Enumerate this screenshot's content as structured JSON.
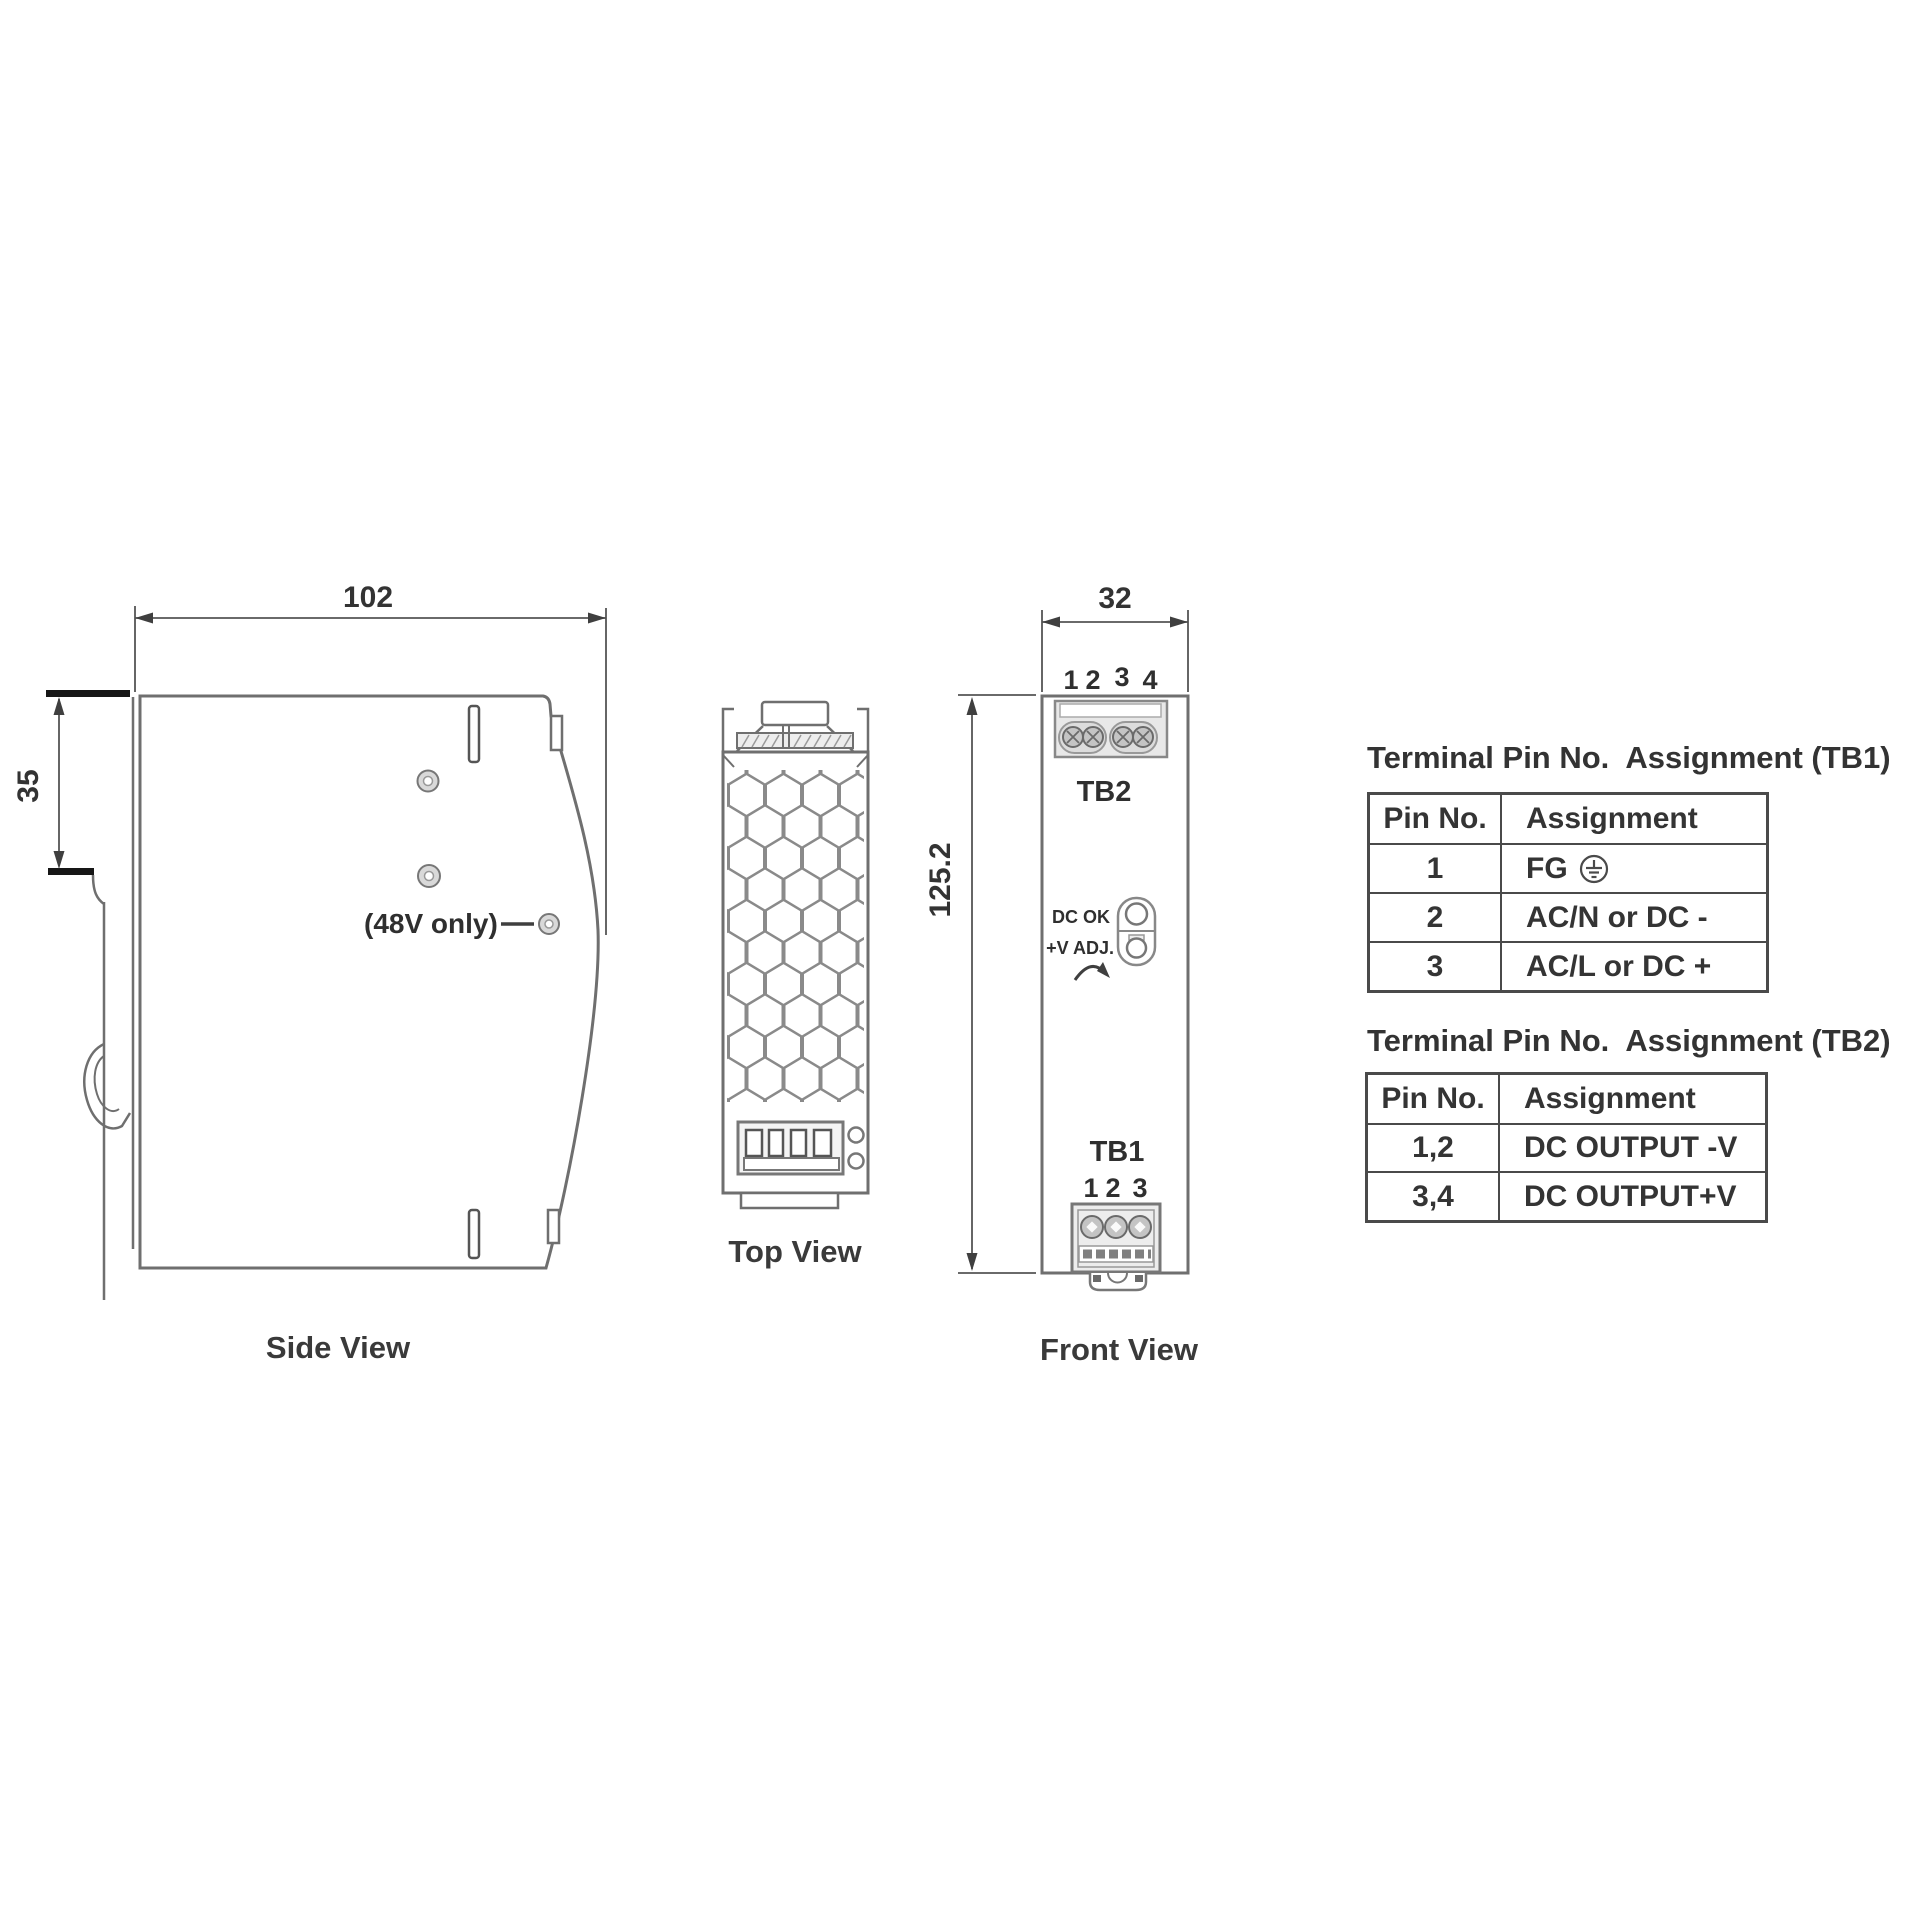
{
  "colors": {
    "line": "#6f6f6f",
    "dim": "#3f3f3f",
    "text": "#2f2f2f",
    "table_border": "#4a4a4a"
  },
  "drawing": {
    "side_view": {
      "label": "Side View",
      "dim_width": "102",
      "dim_rail_height": "35",
      "note": "(48V only)"
    },
    "top_view": {
      "label": "Top View"
    },
    "front_view": {
      "label": "Front View",
      "dim_width": "32",
      "dim_height": "125.2",
      "tb2_label": "TB2",
      "tb1_label": "TB1",
      "dc_ok_label": "DC OK",
      "v_adj_label": "+V ADJ.",
      "tb2_pin_numbers": [
        "1",
        "2",
        "3",
        "4"
      ],
      "tb1_pin_numbers": [
        "1",
        "2",
        "3"
      ]
    }
  },
  "tables": {
    "tb1": {
      "title": "Terminal Pin No.  Assignment (TB1)",
      "headers": {
        "pin": "Pin No.",
        "assignment": "Assignment"
      },
      "rows": [
        {
          "pin": "1",
          "assignment": "FG"
        },
        {
          "pin": "2",
          "assignment": "AC/N or DC -"
        },
        {
          "pin": "3",
          "assignment": "AC/L or DC +"
        }
      ]
    },
    "tb2": {
      "title": "Terminal Pin No.  Assignment (TB2)",
      "headers": {
        "pin": "Pin No.",
        "assignment": "Assignment"
      },
      "rows": [
        {
          "pin": "1,2",
          "assignment": "DC OUTPUT -V"
        },
        {
          "pin": "3,4",
          "assignment": "DC OUTPUT+V"
        }
      ]
    }
  }
}
